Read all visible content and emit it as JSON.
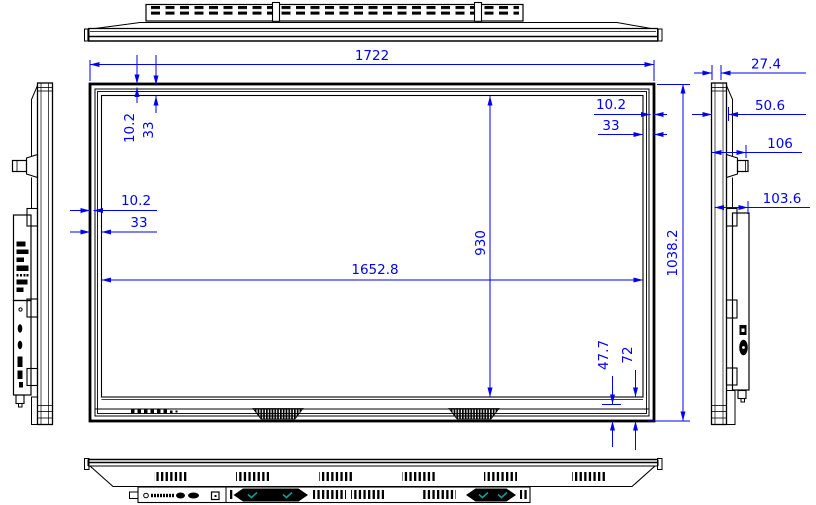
{
  "drawing": {
    "title": "display-panel-dimension-drawing",
    "dimensions": {
      "overall_width": "1722",
      "overall_height": "1038.2",
      "active_area_width": "1652.8",
      "active_area_height": "930",
      "top_bezel_inner": "10.2",
      "top_bezel_outer": "33",
      "left_bezel_inner": "10.2",
      "left_bezel_outer": "33",
      "right_bezel_inner": "10.2",
      "right_bezel_outer": "33",
      "bottom_bezel_inner": "47.7",
      "bottom_bezel_outer": "72",
      "depth_panel_front": "27.4",
      "depth_panel": "50.6",
      "depth_with_handle": "106",
      "depth_back_box": "103.6"
    },
    "colors": {
      "dimension": "#0000ee",
      "outline": "#000000",
      "speaker_accent": "#0f9b9b",
      "background": "#ffffff"
    }
  }
}
